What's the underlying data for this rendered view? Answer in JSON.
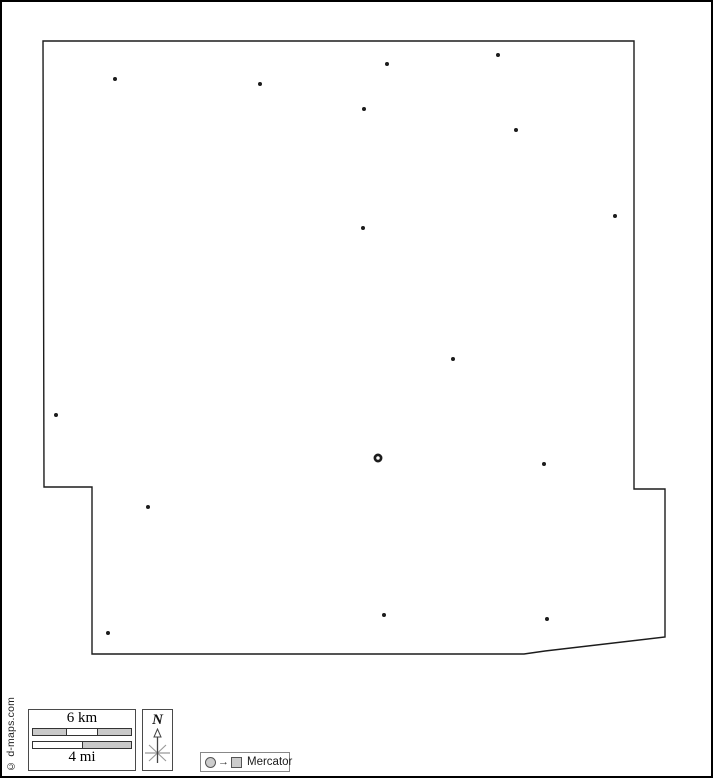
{
  "page": {
    "background": "#ffffff",
    "border_color": "#000000"
  },
  "map": {
    "outline_color": "#1c1c1c",
    "marker_color": "#1c1c1c",
    "fill_color": "#ffffff",
    "outline_points": "41,39 632,39 632,487 663,487 663,635 543,649 522,652 90,652 90,485 42,485",
    "markers": [
      {
        "x": 113,
        "y": 77
      },
      {
        "x": 258,
        "y": 82
      },
      {
        "x": 385,
        "y": 62
      },
      {
        "x": 496,
        "y": 53
      },
      {
        "x": 362,
        "y": 107
      },
      {
        "x": 514,
        "y": 128
      },
      {
        "x": 613,
        "y": 214
      },
      {
        "x": 361,
        "y": 226
      },
      {
        "x": 451,
        "y": 357
      },
      {
        "x": 54,
        "y": 413
      },
      {
        "x": 542,
        "y": 462
      },
      {
        "x": 146,
        "y": 505
      },
      {
        "x": 382,
        "y": 613
      },
      {
        "x": 545,
        "y": 617
      },
      {
        "x": 106,
        "y": 631
      }
    ],
    "capital_marker": {
      "x": 376,
      "y": 456
    }
  },
  "scale_bar": {
    "km_label": "6 km",
    "mi_label": "4 mi",
    "segment_gray": "#c9c9c9",
    "segment_white": "#ffffff"
  },
  "compass": {
    "north_label": "N"
  },
  "projection": {
    "arrow": "→",
    "label": "Mercator"
  },
  "credit": {
    "text": "© d-maps.com"
  }
}
